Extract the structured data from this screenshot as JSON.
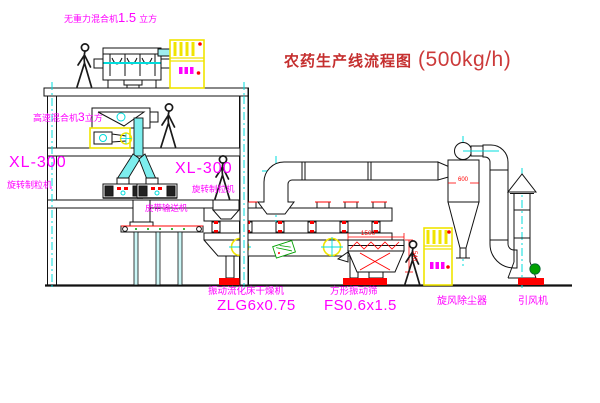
{
  "title": {
    "text_zh": "农药生产线流程图",
    "capacity": "(500kg/h)"
  },
  "labels": {
    "gravity_mixer": {
      "name": "无重力混合机",
      "value": "1.5",
      "unit": "立方"
    },
    "high_speed_mixer": {
      "name": "高速混合机",
      "value": "3",
      "unit": "立方"
    },
    "granulator_left": {
      "model": "XL-300",
      "name": "旋转制粒机"
    },
    "granulator_center": {
      "model": "XL-300",
      "name": "旋转制粒机"
    },
    "belt_conveyor": "皮带输送机",
    "dryer": {
      "name": "振动流化床干燥机",
      "model": "ZLG6x0.75"
    },
    "screen": {
      "name": "方形振动筛",
      "model": "FS0.6x1.5"
    },
    "cyclone": "旋风除尘器",
    "fan": "引风机"
  },
  "dimensions": {
    "screen_length": "1500",
    "screen_height": "540",
    "cyclone_note": "600"
  },
  "icons": {
    "person": "walking-person-figure",
    "control_cabinet": "electric-control-cabinet"
  },
  "colors": {
    "label_magenta": "#ff00ff",
    "title_red": "#c52f2f",
    "line_black": "#111111",
    "centerline_cyan": "#00dcdc",
    "cabinet_yellow": "#f0e400",
    "detail_red": "#ff0000",
    "motor_green": "#00a000",
    "chute_cyan_fill": "#7deeee"
  }
}
